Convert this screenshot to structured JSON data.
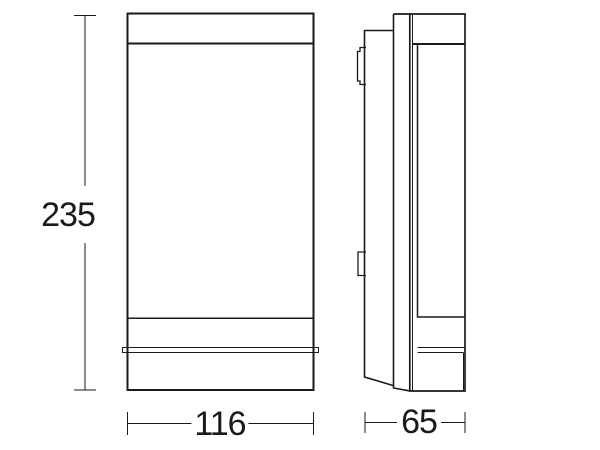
{
  "canvas": {
    "background": "#ffffff",
    "ink": "#1a1a1a"
  },
  "drawing": {
    "kind": "technical dimension drawing",
    "views": [
      "front",
      "side"
    ]
  },
  "dimensions": {
    "height": {
      "label": "235"
    },
    "width": {
      "label": "116"
    },
    "depth": {
      "label": "65"
    }
  }
}
